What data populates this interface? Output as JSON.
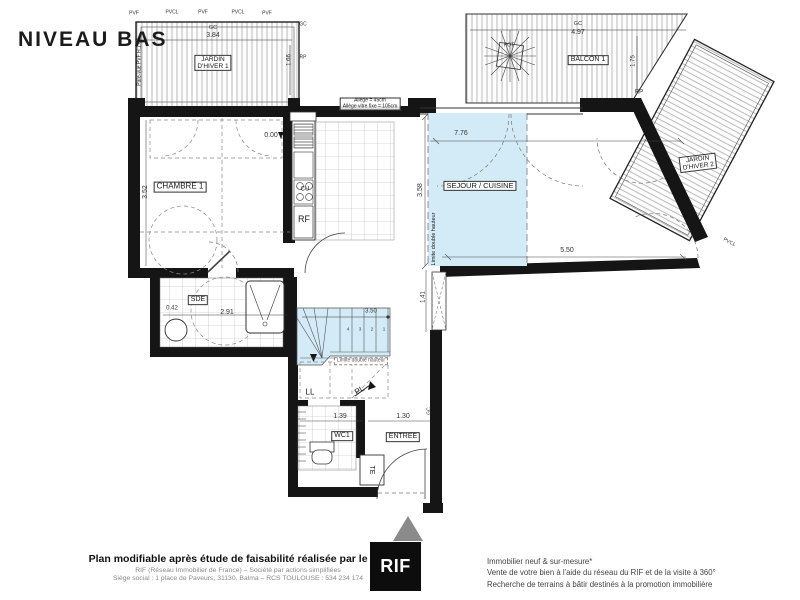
{
  "title": "NIVEAU BAS",
  "colors": {
    "wall": "#151515",
    "double_height_blue": "#d3ebf6",
    "entrance_triangle": "#8a8a8a",
    "logo_bg": "#0d0d0d"
  },
  "plan": {
    "labels": [
      {
        "name": "room-label-jardin-dhiver-1",
        "text": "JARDIN\nD'HIVER 1",
        "x": 213,
        "y": 63,
        "fs": 6.5,
        "rot": 0,
        "cls": "boxed"
      },
      {
        "name": "room-label-balcon-1",
        "text": "BALCON 1",
        "x": 588,
        "y": 60,
        "fs": 7,
        "rot": 0,
        "cls": "boxed"
      },
      {
        "name": "room-label-jardin-dhiver-2",
        "text": "JARDIN\nD'HIVER 2",
        "x": 698,
        "y": 163,
        "fs": 6.5,
        "rot": -7,
        "cls": "boxed"
      },
      {
        "name": "room-label-chambre-1",
        "text": "CHAMBRE 1",
        "x": 180,
        "y": 187,
        "fs": 8,
        "rot": 0,
        "cls": "boxed"
      },
      {
        "name": "room-label-sejour-cuisine",
        "text": "SEJOUR / CUISINE",
        "x": 480,
        "y": 186,
        "fs": 7.5,
        "rot": 0,
        "cls": "boxed"
      },
      {
        "name": "room-label-sde",
        "text": "SDE",
        "x": 198,
        "y": 300,
        "fs": 7,
        "rot": 0,
        "cls": "boxed"
      },
      {
        "name": "room-label-wc1",
        "text": "WC1",
        "x": 342,
        "y": 436,
        "fs": 7,
        "rot": 0,
        "cls": "boxed"
      },
      {
        "name": "room-label-entree",
        "text": "ENTREE",
        "x": 403,
        "y": 437,
        "fs": 7,
        "rot": 0,
        "cls": "boxed"
      },
      {
        "name": "annotation-rf",
        "text": "RF",
        "x": 304,
        "y": 220,
        "fs": 9,
        "rot": 0,
        "cls": ""
      },
      {
        "name": "annotation-cu",
        "text": "CU",
        "x": 305,
        "y": 190,
        "fs": 6,
        "rot": 0,
        "cls": ""
      },
      {
        "name": "annotation-ll",
        "text": "LL",
        "x": 310,
        "y": 393,
        "fs": 8,
        "rot": 0,
        "cls": ""
      },
      {
        "name": "annotation-pl",
        "text": "PL",
        "x": 360,
        "y": 391,
        "fs": 8,
        "rot": -30,
        "cls": ""
      },
      {
        "name": "annotation-te",
        "text": "TE",
        "x": 371,
        "y": 470,
        "fs": 7,
        "rot": 90,
        "cls": ""
      },
      {
        "name": "annotation-pot",
        "text": "POT",
        "x": 509,
        "y": 46,
        "fs": 5,
        "rot": 0,
        "cls": ""
      },
      {
        "name": "annotation-level-0",
        "text": "0.00",
        "x": 271,
        "y": 136,
        "fs": 7,
        "rot": 0,
        "cls": "dimtxt"
      },
      {
        "name": "annotation-allege",
        "text": "Allège = 45cm\nAllège vitre fixe = 105cm",
        "x": 370,
        "y": 104,
        "fs": 5,
        "rot": 0,
        "cls": "boxed"
      },
      {
        "name": "annotation-limite-double-hauteur-vertical",
        "text": "Limite double hauteur",
        "x": 434,
        "y": 239,
        "fs": 5.5,
        "rot": -90,
        "cls": ""
      },
      {
        "name": "annotation-limite-double-hauteur",
        "text": "Limite double hauteur",
        "x": 361,
        "y": 361,
        "fs": 5,
        "rot": 0,
        "cls": "dashedbox"
      },
      {
        "name": "annotation-pare-vue",
        "text": "Pare-vue PVF H:1.80",
        "x": 140,
        "y": 62,
        "fs": 5,
        "rot": -90,
        "cls": ""
      },
      {
        "name": "dim-gc-jd1-top",
        "text": "GC",
        "x": 213,
        "y": 28,
        "fs": 5.5,
        "rot": 0,
        "cls": "dimtxt"
      },
      {
        "name": "dim-3-84",
        "text": "3.84",
        "x": 213,
        "y": 36,
        "fs": 7,
        "rot": 0,
        "cls": "dimtxt"
      },
      {
        "name": "dim-1-66",
        "text": "1.66",
        "x": 290,
        "y": 60,
        "fs": 6,
        "rot": -90,
        "cls": "dimtxt"
      },
      {
        "name": "dim-gc-jd1-right",
        "text": "GC",
        "x": 303,
        "y": 25,
        "fs": 5,
        "rot": 0,
        "cls": "dimtxt"
      },
      {
        "name": "dim-rp-jd1",
        "text": "RP",
        "x": 303,
        "y": 58,
        "fs": 5,
        "rot": 0,
        "cls": "dimtxt"
      },
      {
        "name": "dim-gc-balcon",
        "text": "GC",
        "x": 578,
        "y": 24,
        "fs": 5.5,
        "rot": 0,
        "cls": "dimtxt"
      },
      {
        "name": "dim-4-97",
        "text": "4.97",
        "x": 578,
        "y": 33,
        "fs": 7,
        "rot": 0,
        "cls": "dimtxt"
      },
      {
        "name": "dim-1-75",
        "text": "1.75",
        "x": 634,
        "y": 61,
        "fs": 6,
        "rot": -90,
        "cls": "dimtxt"
      },
      {
        "name": "dim-rp-balcon",
        "text": "RP",
        "x": 639,
        "y": 93,
        "fs": 6,
        "rot": 0,
        "cls": "dimtxt"
      },
      {
        "name": "dim-7-76",
        "text": "7.76",
        "x": 461,
        "y": 134,
        "fs": 7,
        "rot": 0,
        "cls": "dimtxt"
      },
      {
        "name": "dim-3-58",
        "text": "3.58",
        "x": 421,
        "y": 190,
        "fs": 7,
        "rot": -90,
        "cls": "dimtxt"
      },
      {
        "name": "dim-5-50",
        "text": "5.50",
        "x": 567,
        "y": 251,
        "fs": 7,
        "rot": 0,
        "cls": "dimtxt"
      },
      {
        "name": "dim-3-52",
        "text": "3.52",
        "x": 146,
        "y": 192,
        "fs": 7,
        "rot": -90,
        "cls": "dimtxt"
      },
      {
        "name": "dim-0-42",
        "text": "0.42",
        "x": 172,
        "y": 309,
        "fs": 6,
        "rot": 0,
        "cls": "dimtxt"
      },
      {
        "name": "dim-2-91",
        "text": "2.91",
        "x": 227,
        "y": 313,
        "fs": 7,
        "rot": 0,
        "cls": "dimtxt"
      },
      {
        "name": "dim-3-50",
        "text": "3.50",
        "x": 371,
        "y": 312,
        "fs": 6,
        "rot": 0,
        "cls": "dimtxt"
      },
      {
        "name": "dim-1-41",
        "text": "1.41",
        "x": 424,
        "y": 297,
        "fs": 6,
        "rot": -90,
        "cls": "dimtxt"
      },
      {
        "name": "dim-1-39",
        "text": "1.39",
        "x": 340,
        "y": 417,
        "fs": 7,
        "rot": 0,
        "cls": "dimtxt"
      },
      {
        "name": "dim-1-30",
        "text": "1.30",
        "x": 403,
        "y": 417,
        "fs": 7,
        "rot": 0,
        "cls": "dimtxt"
      },
      {
        "name": "dim-gc-entree",
        "text": "GC",
        "x": 430,
        "y": 411,
        "fs": 5,
        "rot": -90,
        "cls": "dimtxt"
      },
      {
        "name": "tick-pvf-1",
        "text": "PVF",
        "x": 134,
        "y": 14,
        "fs": 5,
        "rot": 0,
        "cls": "dimtxt"
      },
      {
        "name": "tick-pvcl-1",
        "text": "PVCL",
        "x": 172,
        "y": 13,
        "fs": 5,
        "rot": 0,
        "cls": "dimtxt"
      },
      {
        "name": "tick-pvf-2",
        "text": "PVF",
        "x": 203,
        "y": 13,
        "fs": 5,
        "rot": 0,
        "cls": "dimtxt"
      },
      {
        "name": "tick-pvcl-2",
        "text": "PVCL",
        "x": 238,
        "y": 13,
        "fs": 5,
        "rot": 0,
        "cls": "dimtxt"
      },
      {
        "name": "tick-pvf-3",
        "text": "PVF",
        "x": 267,
        "y": 14,
        "fs": 5,
        "rot": 0,
        "cls": "dimtxt"
      },
      {
        "name": "tick-pvcl-jd2",
        "text": "PVCL",
        "x": 729,
        "y": 243,
        "fs": 5,
        "rot": 28,
        "cls": "dimtxt"
      },
      {
        "name": "stair-step-4",
        "text": "4",
        "x": 348,
        "y": 330,
        "fs": 4.5,
        "rot": 0,
        "cls": "dimtxt"
      },
      {
        "name": "stair-step-3",
        "text": "3",
        "x": 360,
        "y": 330,
        "fs": 4.5,
        "rot": 0,
        "cls": "dimtxt"
      },
      {
        "name": "stair-step-2",
        "text": "2",
        "x": 372,
        "y": 330,
        "fs": 4.5,
        "rot": 0,
        "cls": "dimtxt"
      },
      {
        "name": "stair-step-1",
        "text": "1",
        "x": 384,
        "y": 330,
        "fs": 4.5,
        "rot": 0,
        "cls": "dimtxt"
      }
    ]
  },
  "footer": {
    "left_bold": "Plan modifiable après étude de faisabilité réalisée par le RIF",
    "left_line2": "RIF (Réseau Immobilier de France) – Société par actions simplifiées",
    "left_line3": "Siège social : 1 place de Paveurs, 31130, Balma – RCS TOULOUSE : 534 234 174",
    "logo_text": "RIF",
    "right_line1": "Immobilier neuf & sur-mesure*",
    "right_line2": "Vente de votre bien à l'aide du réseau du RIF et de la visite à 360°",
    "right_line3": "Recherche de terrains à bâtir destinés à la promotion immobilière"
  }
}
